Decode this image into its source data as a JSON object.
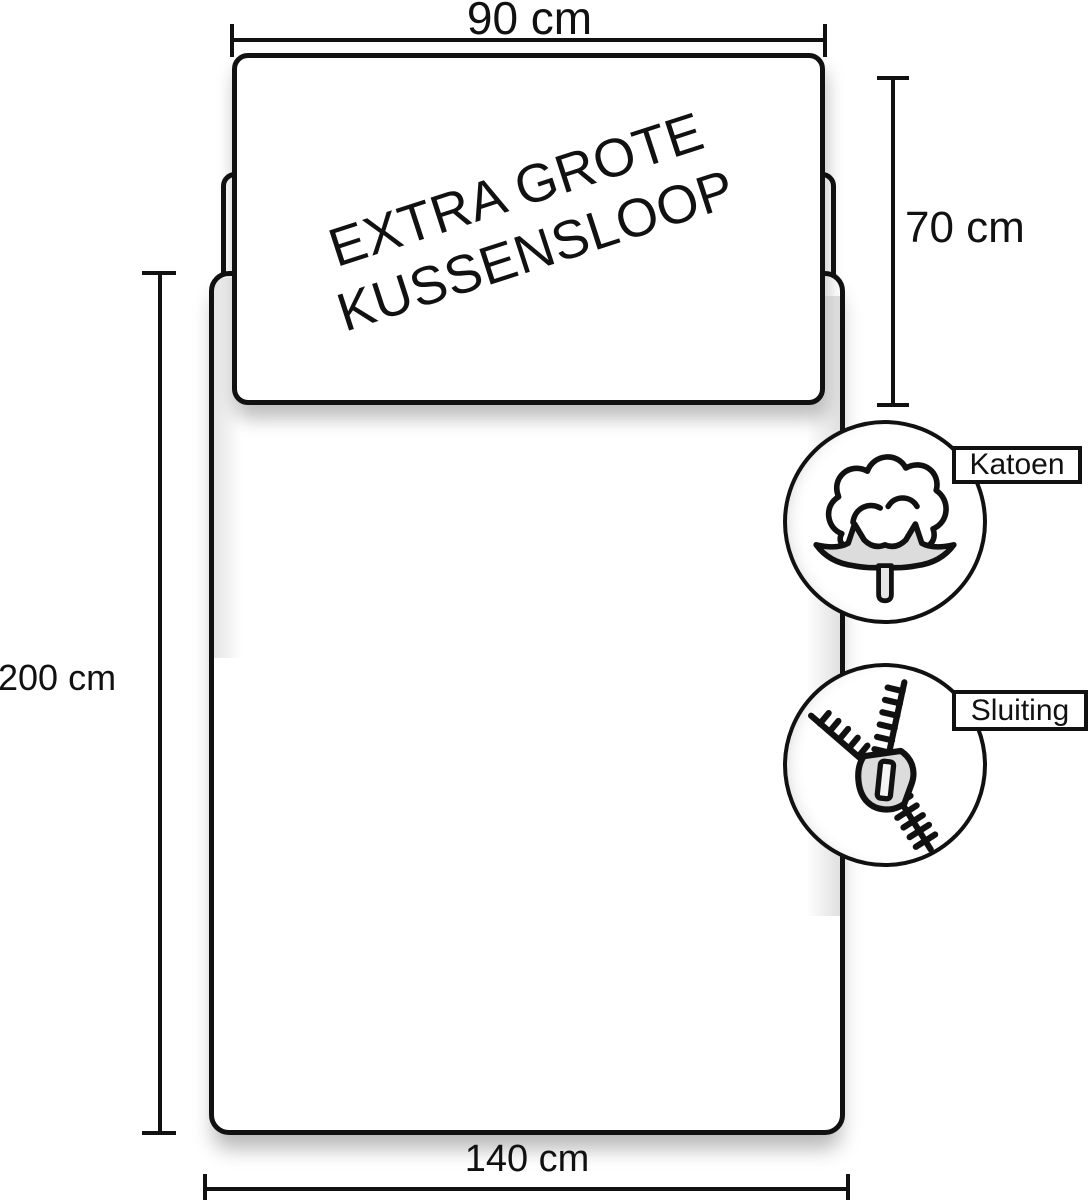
{
  "diagram": {
    "name": "bedding-size-diagram",
    "pillow": {
      "line1": "EXTRA GROTE",
      "line2": "KUSSENSLOOP"
    },
    "dimensions": {
      "pillow_width": "90 cm",
      "pillow_height": "70 cm",
      "duvet_height": "200 cm",
      "duvet_width": "140 cm"
    },
    "badges": [
      {
        "icon": "cotton-icon",
        "label": "Katoen"
      },
      {
        "icon": "zipper-icon",
        "label": "Sluiting"
      }
    ],
    "colors": {
      "line": "#111111",
      "background": "#ffffff",
      "icon_gray": "#dcdcdc"
    }
  }
}
